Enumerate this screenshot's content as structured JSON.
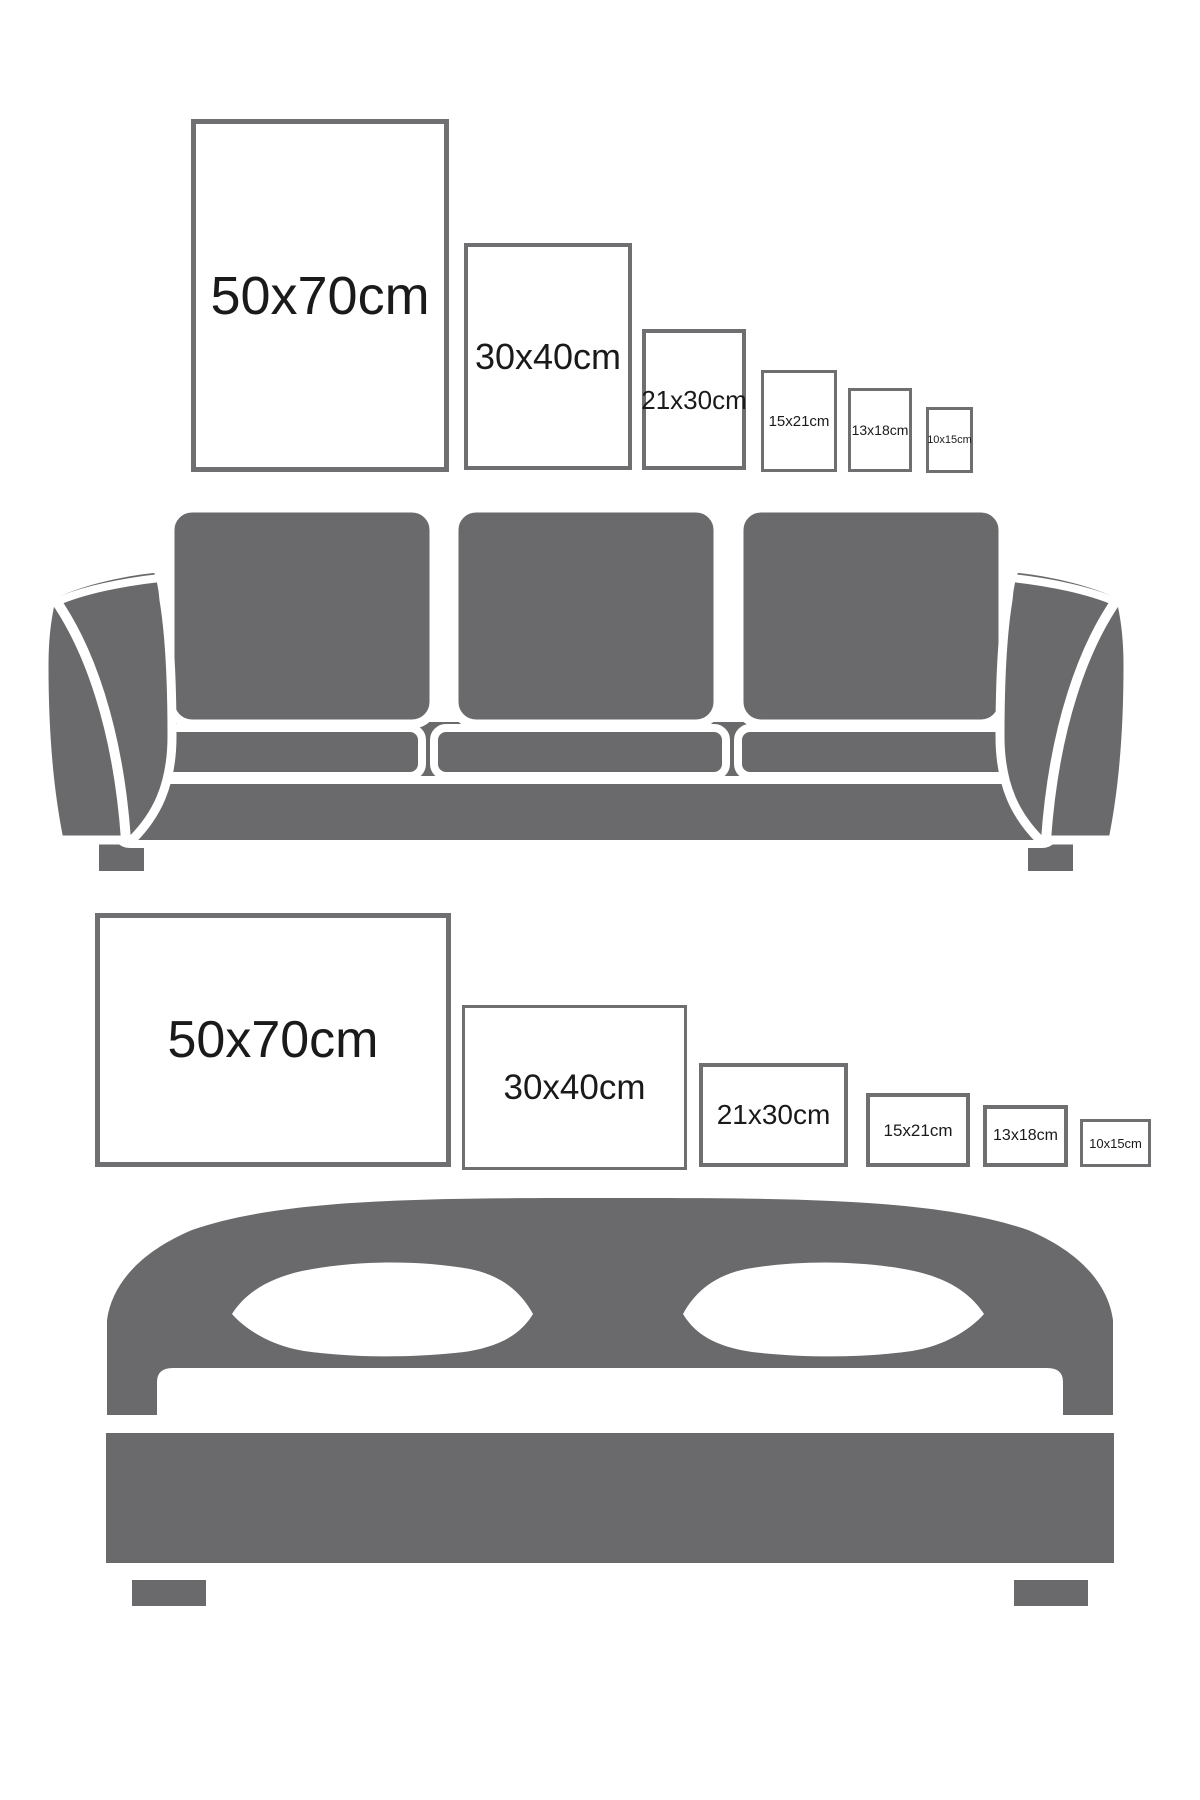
{
  "colors": {
    "furniture_gray": "#6a6a6c",
    "frame_border": "#6f6f71",
    "label_text": "#1a1a1a",
    "background": "#ffffff"
  },
  "sections": {
    "sofa": {
      "furniture": "sofa",
      "orientation": "portrait",
      "frames": [
        {
          "label": "50x70cm"
        },
        {
          "label": "30x40cm"
        },
        {
          "label": "21x30cm"
        },
        {
          "label": "15x21cm"
        },
        {
          "label": "13x18cm"
        },
        {
          "label": "10x15cm"
        }
      ]
    },
    "bed": {
      "furniture": "bed",
      "orientation": "landscape",
      "frames": [
        {
          "label": "50x70cm"
        },
        {
          "label": "30x40cm"
        },
        {
          "label": "21x30cm"
        },
        {
          "label": "15x21cm"
        },
        {
          "label": "13x18cm"
        },
        {
          "label": "10x15cm"
        }
      ]
    }
  }
}
